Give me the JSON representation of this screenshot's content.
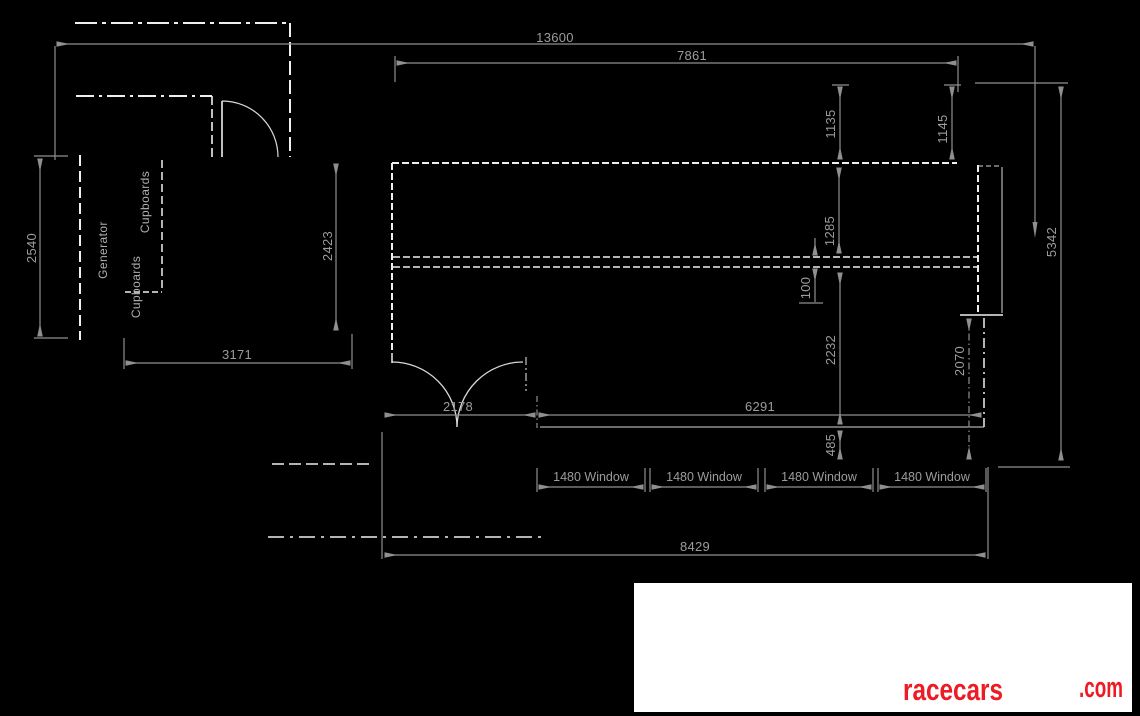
{
  "drawing": {
    "dimensions": {
      "overall_width": "13600",
      "upper_width": "7861",
      "garage_depth": "2540",
      "garage_inner_depth": "2423",
      "garage_width": "3171",
      "offset_left": "1135",
      "offset_right": "1145",
      "front_room_depth": "1285",
      "wall_gap": "100",
      "rear_room_depth": "2232",
      "sill_offset": "485",
      "side_section": "2070",
      "overall_depth": "5342",
      "door_opening": "2178",
      "window_run": "6291",
      "lower_width": "8429"
    },
    "windows": [
      "1480 Window",
      "1480 Window",
      "1480 Window",
      "1480 Window"
    ],
    "labels": {
      "generator": "Generator",
      "cupboards_upper": "Cupboards",
      "cupboards_lower": "Cupboards"
    },
    "colors": {
      "background": "#000000",
      "wall_line": "#efefef",
      "dimension_line": "#8f8f8f",
      "dimension_text": "#9c9c9c",
      "logo_red": "#ed1c24",
      "logo_background": "#ffffff"
    }
  },
  "logo": {
    "brand": "racecars",
    "suffix": ".com"
  }
}
